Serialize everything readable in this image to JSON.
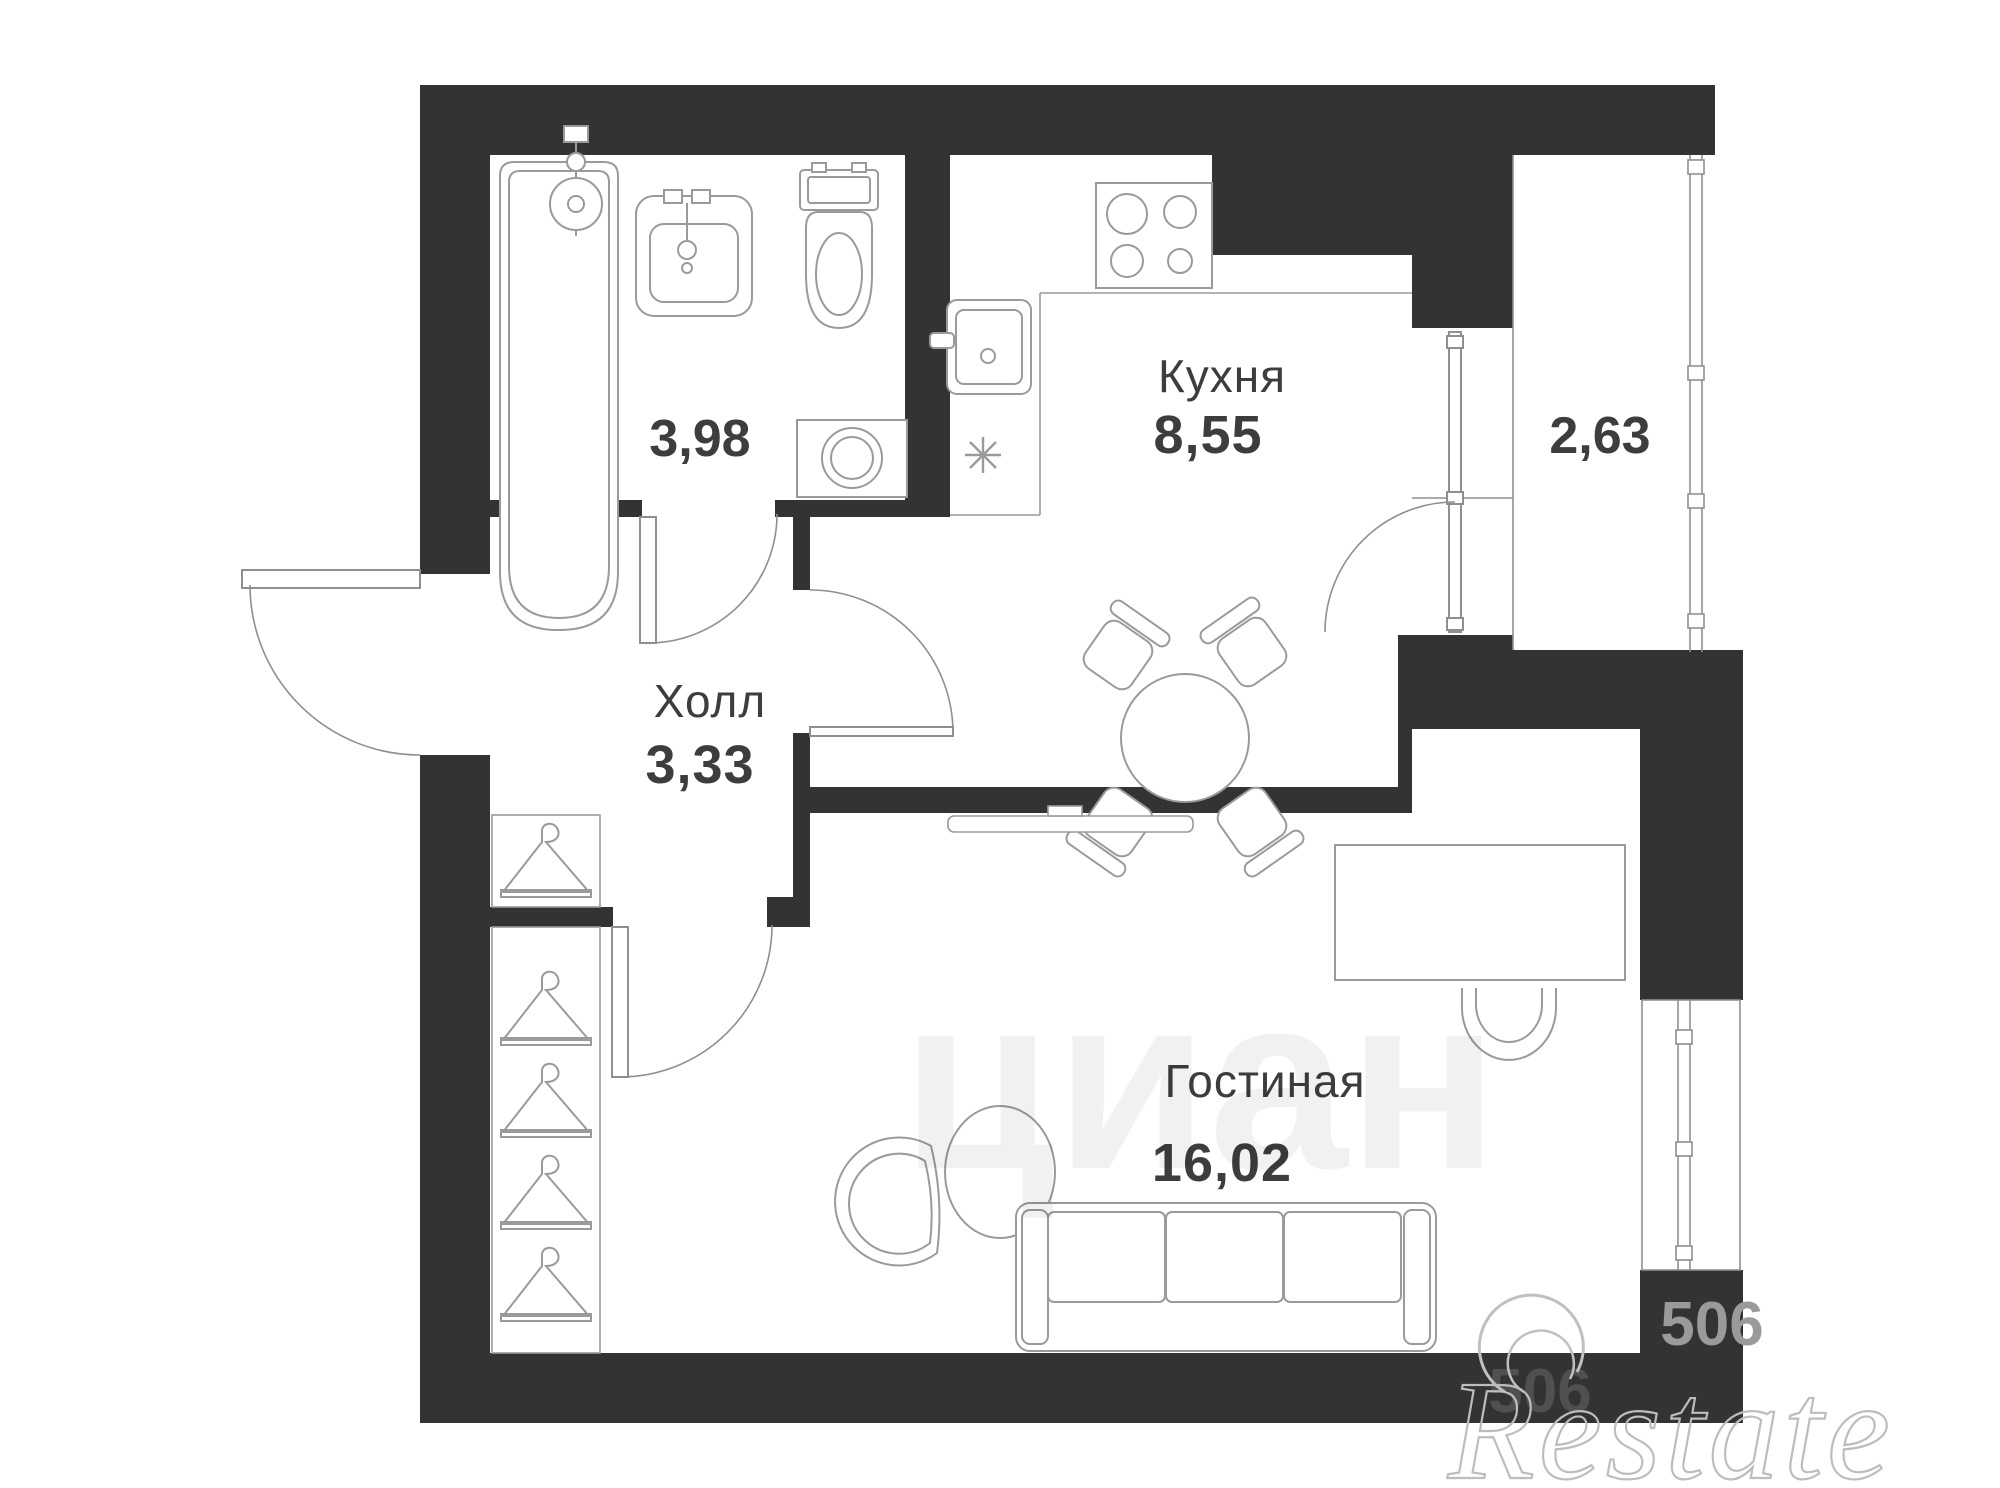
{
  "rooms": [
    {
      "key": "bathroom",
      "name": "",
      "area": "3,98"
    },
    {
      "key": "kitchen",
      "name": "Кухня",
      "area": "8,55"
    },
    {
      "key": "balcony",
      "name": "",
      "area": "2,63"
    },
    {
      "key": "hall",
      "name": "Холл",
      "area": "3,33"
    },
    {
      "key": "living-room",
      "name": "Гостиная",
      "area": "16,02"
    }
  ],
  "fixtures": {
    "bathroom": [
      "bathtub-icon",
      "bath-sink-icon",
      "toilet-icon",
      "washing-machine-icon"
    ],
    "kitchen": [
      "stove-icon",
      "kitchen-sink-icon",
      "asterisk-symbol",
      "dining-table-icon",
      "dining-chair-icon"
    ],
    "hall": [
      "entrance-door-icon",
      "hanger-icon"
    ],
    "living-room": [
      "wardrobe-hangers-icon",
      "tv-console-icon",
      "desk-icon",
      "desk-chair-icon",
      "coffee-table-icon",
      "armchair-icon",
      "sofa-icon"
    ],
    "balcony": [
      "balcony-door-icon",
      "window-icon"
    ]
  },
  "watermarks": {
    "brand": "Restate",
    "portal": "циан",
    "digits": "506"
  },
  "colors": {
    "wall": "#333333",
    "furniture_line": "#9a9a9a",
    "label_text": "#3d3d3d",
    "watermark_gray": "#9a9a9a"
  }
}
